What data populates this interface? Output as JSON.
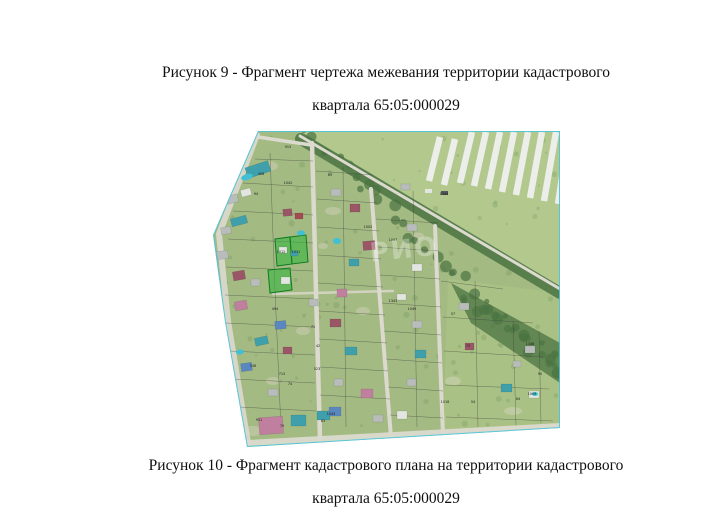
{
  "figure9_caption": {
    "line1": "Рисунок 9 - Фрагмент чертежа межевания территории кадастрового",
    "line2": "квартала 65:05:000029"
  },
  "figure10_caption": {
    "line1": "Рисунок 10 - Фрагмент кадастрового плана на территории кадастрового",
    "line2": "квартала 65:05:000029"
  },
  "map": {
    "palette": {
      "village": "#a3ba82",
      "field": "#b2c88d",
      "rural": "#aac185",
      "road": "#dcdacf",
      "soil": "#dcd8c6",
      "tree": "#5d8a50",
      "treeDark": "#4a7342",
      "parcel": "#3c3c3c",
      "boundary": "#4cc4da",
      "greenFill": "#2db43c",
      "greenStroke": "#117a20",
      "greenhouse": "#eceee9",
      "pool": "#3fc0d4",
      "maroon": "#9a5566",
      "pink": "#c07f9e",
      "teal": "#3fa0ab",
      "blue": "#5b87c0",
      "gray": "#b8bcba",
      "white": "#e3e5e0",
      "red": "#a34b52",
      "dark": "#60646a"
    },
    "outline": "45,0 347,0 347,297 34,316 12,191 0,104",
    "field_polygon": "87,0 347,0 347,158",
    "rural_polygon": "235,148 347,162 347,297 230,303",
    "tree_band_path": "M88,8 L347,162",
    "tree_fan_polygon": "238,152 347,212 347,252 258,192",
    "roads": [
      {
        "d": "M44,4 L6,103 L15,190 L35,312",
        "w": 6,
        "o": 0.9
      },
      {
        "d": "M35,312 L347,295",
        "w": 6,
        "o": 0.95
      },
      {
        "d": "M45,6 L98,14",
        "w": 3.5,
        "o": 1
      },
      {
        "d": "M87,5 L347,158",
        "w": 3,
        "o": 1
      },
      {
        "d": "M99,12 L107,308",
        "w": 4.5,
        "o": 1
      },
      {
        "d": "M158,58 L178,306",
        "w": 4,
        "o": 1
      },
      {
        "d": "M222,95 L230,304",
        "w": 4,
        "o": 1
      },
      {
        "d": "M60,163 L180,160",
        "w": 2.5,
        "o": 0.8
      }
    ],
    "parcel_lines": [
      [
        42,
        28,
        100,
        30
      ],
      [
        30,
        52,
        100,
        56
      ],
      [
        20,
        80,
        100,
        84
      ],
      [
        15,
        108,
        100,
        112
      ],
      [
        13,
        136,
        100,
        140
      ],
      [
        12,
        164,
        100,
        168
      ],
      [
        13,
        192,
        101,
        196
      ],
      [
        16,
        220,
        102,
        224
      ],
      [
        20,
        248,
        102,
        252
      ],
      [
        26,
        276,
        103,
        280
      ],
      [
        57,
        22,
        62,
        160
      ],
      [
        62,
        160,
        68,
        298
      ],
      [
        103,
        40,
        160,
        44
      ],
      [
        104,
        68,
        164,
        72
      ],
      [
        104,
        96,
        166,
        100
      ],
      [
        105,
        124,
        168,
        128
      ],
      [
        105,
        152,
        170,
        156
      ],
      [
        106,
        180,
        172,
        184
      ],
      [
        106,
        208,
        174,
        212
      ],
      [
        107,
        236,
        175,
        240
      ],
      [
        107,
        264,
        177,
        268
      ],
      [
        130,
        36,
        133,
        296
      ],
      [
        163,
        88,
        225,
        92
      ],
      [
        165,
        116,
        226,
        120
      ],
      [
        167,
        144,
        227,
        148
      ],
      [
        169,
        172,
        228,
        176
      ],
      [
        171,
        200,
        228,
        204
      ],
      [
        173,
        228,
        229,
        232
      ],
      [
        175,
        256,
        230,
        260
      ],
      [
        177,
        284,
        230,
        287
      ],
      [
        200,
        60,
        204,
        296
      ],
      [
        228,
        150,
        290,
        158
      ],
      [
        230,
        186,
        320,
        192
      ],
      [
        231,
        220,
        330,
        226
      ],
      [
        232,
        254,
        336,
        258
      ],
      [
        233,
        286,
        340,
        290
      ],
      [
        262,
        150,
        265,
        296
      ],
      [
        300,
        190,
        303,
        294
      ],
      [
        326,
        200,
        328,
        292
      ]
    ],
    "green_parcels": [
      "62,108 77,106 79,133 64,135",
      "77,106 93,104 95,131 79,133",
      "55,139 77,137 79,159 57,162"
    ],
    "greenhouses": [
      [
        216,
        50,
        227,
        6
      ],
      [
        231,
        54,
        242,
        8
      ],
      [
        247,
        52,
        259,
        1
      ],
      [
        261,
        55,
        273,
        1
      ],
      [
        275,
        58,
        287,
        1
      ],
      [
        289,
        61,
        301,
        1
      ],
      [
        303,
        64,
        315,
        1
      ],
      [
        317,
        67,
        329,
        1
      ],
      [
        331,
        70,
        343,
        1
      ],
      [
        345,
        73,
        356,
        1
      ]
    ],
    "sheds": [
      [
        212,
        58,
        7,
        4,
        "#e3e5e0"
      ],
      [
        228,
        60,
        7,
        4,
        "#555a5c"
      ]
    ],
    "houses": [
      [
        33,
        33,
        24,
        11,
        "teal",
        -18
      ],
      [
        14,
        64,
        11,
        8,
        "gray",
        -15
      ],
      [
        28,
        58,
        10,
        7,
        "white",
        -15
      ],
      [
        8,
        96,
        10,
        7,
        "gray",
        -10
      ],
      [
        18,
        86,
        16,
        8,
        "teal",
        -15
      ],
      [
        4,
        120,
        11,
        8,
        "gray",
        -8
      ],
      [
        20,
        140,
        12,
        9,
        "maroon",
        -10
      ],
      [
        22,
        170,
        12,
        9,
        "pink",
        -10
      ],
      [
        38,
        148,
        9,
        7,
        "gray",
        0
      ],
      [
        70,
        78,
        9,
        7,
        "maroon",
        -5
      ],
      [
        82,
        82,
        8,
        6,
        "red",
        0
      ],
      [
        66,
        116,
        8,
        6,
        "white",
        0
      ],
      [
        78,
        120,
        7,
        5,
        "teal",
        0
      ],
      [
        68,
        146,
        9,
        7,
        "white",
        0
      ],
      [
        62,
        190,
        11,
        8,
        "blue",
        -5
      ],
      [
        42,
        206,
        13,
        8,
        "teal",
        -12
      ],
      [
        70,
        216,
        9,
        7,
        "maroon",
        0
      ],
      [
        28,
        232,
        11,
        8,
        "blue",
        -8
      ],
      [
        55,
        258,
        10,
        7,
        "gray",
        0
      ],
      [
        46,
        286,
        24,
        17,
        "pink",
        -4
      ],
      [
        78,
        284,
        15,
        11,
        "teal",
        0
      ],
      [
        104,
        280,
        13,
        9,
        "teal",
        0
      ],
      [
        96,
        168,
        9,
        7,
        "gray",
        0
      ],
      [
        118,
        58,
        10,
        7,
        "gray",
        0
      ],
      [
        137,
        73,
        10,
        8,
        "maroon",
        0
      ],
      [
        150,
        110,
        12,
        9,
        "maroon",
        -5
      ],
      [
        136,
        128,
        10,
        7,
        "teal",
        0
      ],
      [
        124,
        158,
        10,
        8,
        "pink",
        0
      ],
      [
        117,
        188,
        11,
        8,
        "maroon",
        0
      ],
      [
        132,
        216,
        12,
        8,
        "teal",
        0
      ],
      [
        121,
        248,
        9,
        7,
        "gray",
        0
      ],
      [
        116,
        276,
        12,
        9,
        "blue",
        0
      ],
      [
        148,
        258,
        12,
        9,
        "pink",
        0
      ],
      [
        160,
        284,
        10,
        7,
        "gray",
        0
      ],
      [
        188,
        53,
        9,
        6,
        "gray",
        0
      ],
      [
        194,
        93,
        10,
        7,
        "gray",
        0
      ],
      [
        199,
        133,
        10,
        7,
        "white",
        0
      ],
      [
        184,
        163,
        9,
        6,
        "white",
        0
      ],
      [
        199,
        190,
        10,
        7,
        "gray",
        0
      ],
      [
        202,
        219,
        11,
        8,
        "teal",
        0
      ],
      [
        194,
        248,
        9,
        7,
        "gray",
        0
      ],
      [
        184,
        280,
        10,
        8,
        "white",
        0
      ],
      [
        246,
        172,
        10,
        7,
        "gray",
        0
      ],
      [
        252,
        212,
        9,
        7,
        "maroon",
        0
      ],
      [
        288,
        253,
        11,
        8,
        "teal",
        0
      ],
      [
        312,
        215,
        10,
        7,
        "gray",
        0
      ],
      [
        316,
        260,
        10,
        7,
        "white",
        0
      ],
      [
        300,
        230,
        8,
        6,
        "gray",
        0
      ]
    ],
    "pools": [
      [
        34,
        46,
        6,
        3,
        -18
      ],
      [
        88,
        102,
        4,
        2.5,
        0
      ],
      [
        124,
        110,
        4,
        3,
        0
      ],
      [
        27,
        221,
        4,
        2.5,
        -8
      ],
      [
        322,
        263,
        3,
        2,
        0
      ]
    ],
    "soil_patches": [
      [
        55,
        35,
        10,
        5
      ],
      [
        120,
        80,
        8,
        4
      ],
      [
        90,
        200,
        7,
        4
      ],
      [
        150,
        180,
        7,
        4
      ],
      [
        205,
        105,
        6,
        3.5
      ],
      [
        240,
        250,
        8,
        4.5
      ],
      [
        60,
        250,
        7,
        4
      ],
      [
        110,
        115,
        5,
        3
      ],
      [
        40,
        300,
        12,
        5
      ],
      [
        300,
        280,
        9,
        4
      ]
    ],
    "labels": [
      {
        "t": "915",
        "x": 75,
        "y": 17
      },
      {
        "t": "408",
        "x": 48,
        "y": 44
      },
      {
        "t": "1042",
        "x": 75,
        "y": 53
      },
      {
        "t": "69",
        "x": 117,
        "y": 45
      },
      {
        "t": "94",
        "x": 43,
        "y": 64
      },
      {
        "t": "1002",
        "x": 155,
        "y": 97
      },
      {
        "t": "1047",
        "x": 180,
        "y": 110
      },
      {
        "t": "1344",
        "x": 231,
        "y": 64
      },
      {
        "t": "1012",
        "x": 68,
        "y": 122
      },
      {
        "t": "1011",
        "x": 83,
        "y": 122
      },
      {
        "t": "494",
        "x": 62,
        "y": 179
      },
      {
        "t": "71",
        "x": 100,
        "y": 197
      },
      {
        "t": "42",
        "x": 105,
        "y": 216
      },
      {
        "t": "538",
        "x": 40,
        "y": 236
      },
      {
        "t": "715",
        "x": 69,
        "y": 244
      },
      {
        "t": "74",
        "x": 77,
        "y": 254
      },
      {
        "t": "523",
        "x": 104,
        "y": 239
      },
      {
        "t": "1343",
        "x": 180,
        "y": 171
      },
      {
        "t": "1049",
        "x": 199,
        "y": 179
      },
      {
        "t": "57",
        "x": 240,
        "y": 184
      },
      {
        "t": "73",
        "x": 255,
        "y": 216
      },
      {
        "t": "1348",
        "x": 317,
        "y": 214
      },
      {
        "t": "1018",
        "x": 232,
        "y": 272
      },
      {
        "t": "54",
        "x": 260,
        "y": 272
      },
      {
        "t": "64",
        "x": 305,
        "y": 269
      },
      {
        "t": "1009",
        "x": 319,
        "y": 264
      },
      {
        "t": "90",
        "x": 327,
        "y": 244
      },
      {
        "t": "931",
        "x": 46,
        "y": 290
      },
      {
        "t": "79",
        "x": 69,
        "y": 296
      },
      {
        "t": "83",
        "x": 110,
        "y": 291
      },
      {
        "t": "1043",
        "x": 118,
        "y": 284
      }
    ],
    "watermark": {
      "text": "РИО",
      "x": 192,
      "y": 127,
      "size": 26,
      "opacity": 0.3,
      "rotate": -6
    }
  }
}
